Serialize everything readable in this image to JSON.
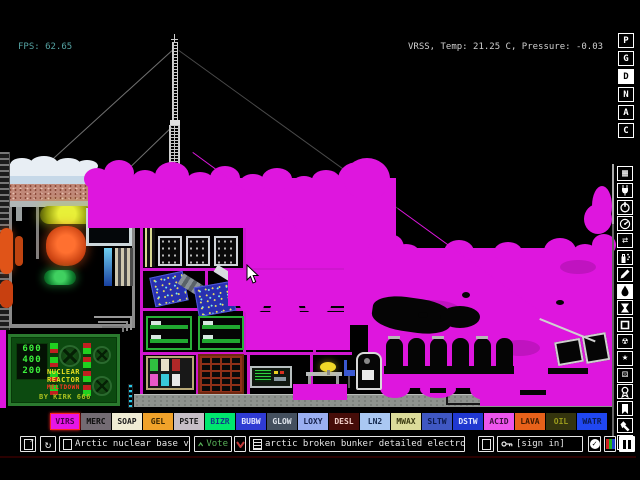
{
  "hud": {
    "fps": "FPS: 62.65",
    "status": "VRSS, Temp: 21.25 C, Pressure: -0.03"
  },
  "menu_letters": [
    {
      "label": "P",
      "active": false
    },
    {
      "label": "G",
      "active": false
    },
    {
      "label": "D",
      "active": true
    },
    {
      "label": "N",
      "active": false
    },
    {
      "label": "A",
      "active": false
    },
    {
      "label": "C",
      "active": false
    }
  ],
  "tool_icons": [
    {
      "name": "keyboard-icon",
      "active": false
    },
    {
      "name": "plug-icon",
      "active": false
    },
    {
      "name": "power-icon",
      "active": false
    },
    {
      "name": "gauge-icon",
      "active": false
    },
    {
      "name": "swap-arrows-icon",
      "active": false
    },
    {
      "name": "spray-icon",
      "active": false
    },
    {
      "name": "pencil-icon",
      "active": false
    },
    {
      "name": "drop-icon",
      "active": true
    },
    {
      "name": "hourglass-icon",
      "active": false
    },
    {
      "name": "square-icon",
      "active": false
    },
    {
      "name": "radiation-icon",
      "active": false
    },
    {
      "name": "star-icon",
      "active": false
    },
    {
      "name": "dice-icon",
      "active": false
    },
    {
      "name": "medal-icon",
      "active": false
    },
    {
      "name": "bookmark-icon",
      "active": false
    },
    {
      "name": "hammer-icon",
      "active": false
    },
    {
      "name": "search-icon",
      "active": false
    }
  ],
  "palette": [
    {
      "label": "VIRS",
      "bg": "#e616e6",
      "fg": "#4a004a",
      "selected": true
    },
    {
      "label": "MERC",
      "bg": "#736b73",
      "fg": "#0c0c0c",
      "selected": false
    },
    {
      "label": "SOAP",
      "bg": "#f0ecd4",
      "fg": "#1a1a1a",
      "selected": false
    },
    {
      "label": "GEL",
      "bg": "#f0a22a",
      "fg": "#3a2600",
      "selected": false
    },
    {
      "label": "PSTE",
      "bg": "#c6bec6",
      "fg": "#1a1a1a",
      "selected": false
    },
    {
      "label": "BIZR",
      "bg": "#00e76e",
      "fg": "#103a8a",
      "selected": false
    },
    {
      "label": "BUBW",
      "bg": "#2f3bd3",
      "fg": "#e6e9ff",
      "selected": false
    },
    {
      "label": "GLOW",
      "bg": "#44505e",
      "fg": "#dfe5ec",
      "selected": false
    },
    {
      "label": "LOXY",
      "bg": "#9aaff0",
      "fg": "#15204a",
      "selected": false
    },
    {
      "label": "DESL",
      "bg": "#460d08",
      "fg": "#f2cfc8",
      "selected": false
    },
    {
      "label": "LN2",
      "bg": "#aac8f2",
      "fg": "#13294e",
      "selected": false
    },
    {
      "label": "MWAX",
      "bg": "#dcdc9a",
      "fg": "#39390f",
      "selected": false
    },
    {
      "label": "SLTW",
      "bg": "#3f57c2",
      "fg": "#0c1a4e",
      "selected": false
    },
    {
      "label": "DSTW",
      "bg": "#2038d0",
      "fg": "#e2e8ff",
      "selected": false
    },
    {
      "label": "ACID",
      "bg": "#ed55ec",
      "fg": "#3c0f3c",
      "selected": false
    },
    {
      "label": "LAVA",
      "bg": "#e8611a",
      "fg": "#401b00",
      "selected": false
    },
    {
      "label": "OIL",
      "bg": "#34340e",
      "fg": "#9a9a1c",
      "selected": false
    },
    {
      "label": "WATR",
      "bg": "#2047f0",
      "fg": "#0a1a50",
      "selected": false
    }
  ],
  "bottom_bar": {
    "save_title": "Arctic nuclear base v.1",
    "vote_label": "Vote",
    "tag_text": "arctic broken bunker detailed electronic...",
    "sign_in_label": "[sign in]"
  },
  "scene": {
    "reactor_sign": {
      "readouts": [
        "600",
        "400",
        "200"
      ],
      "title_line1": "NUCLEAR",
      "title_line2": "REACTOR",
      "warning": "MELTDOWN",
      "credit": "BY KIRK 666"
    }
  },
  "colors": {
    "virus": "#de16de",
    "fps_text": "#55a3a3",
    "status_text": "#d0d0d0",
    "vote_up": "#58b058",
    "vote_down": "#c03838",
    "selected_border": "#ff2424"
  }
}
